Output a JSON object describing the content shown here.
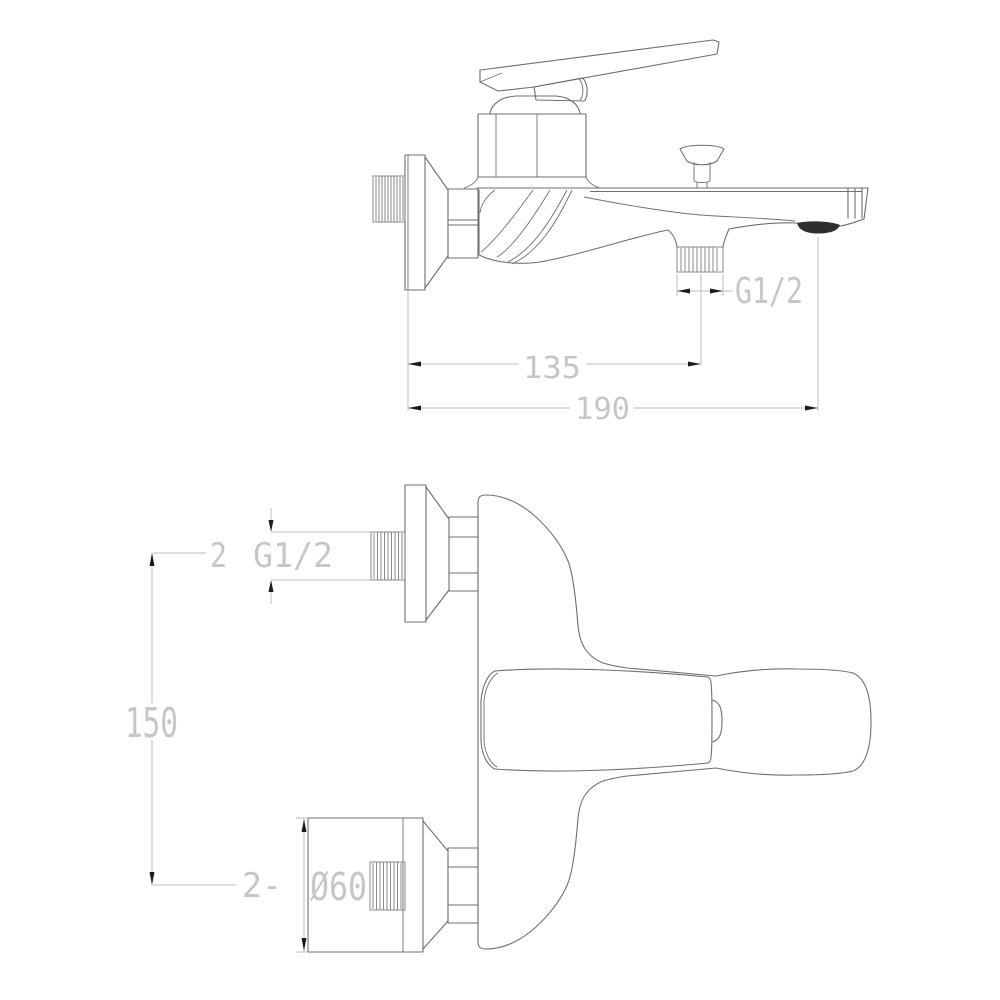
{
  "title": "Wall-mounted bath mixer tap — dimensioned technical drawing",
  "colors": {
    "bg": "#ffffff",
    "outline": "#6f6f6f",
    "thread": "#7d7d7d",
    "dim": "#bdbdbd",
    "dimtext": "#c6c6c6",
    "arrow": "#1c1c1c",
    "dark": "#2e2e2e"
  },
  "side_view": {
    "dim_g12": "G1/2",
    "dim_135": "135",
    "dim_190": "190"
  },
  "plan_view": {
    "qty_top": "2",
    "dim_g12": "G1/2",
    "dim_150": "150",
    "qty_bottom": "2-",
    "dim_d60": "Ø60"
  }
}
